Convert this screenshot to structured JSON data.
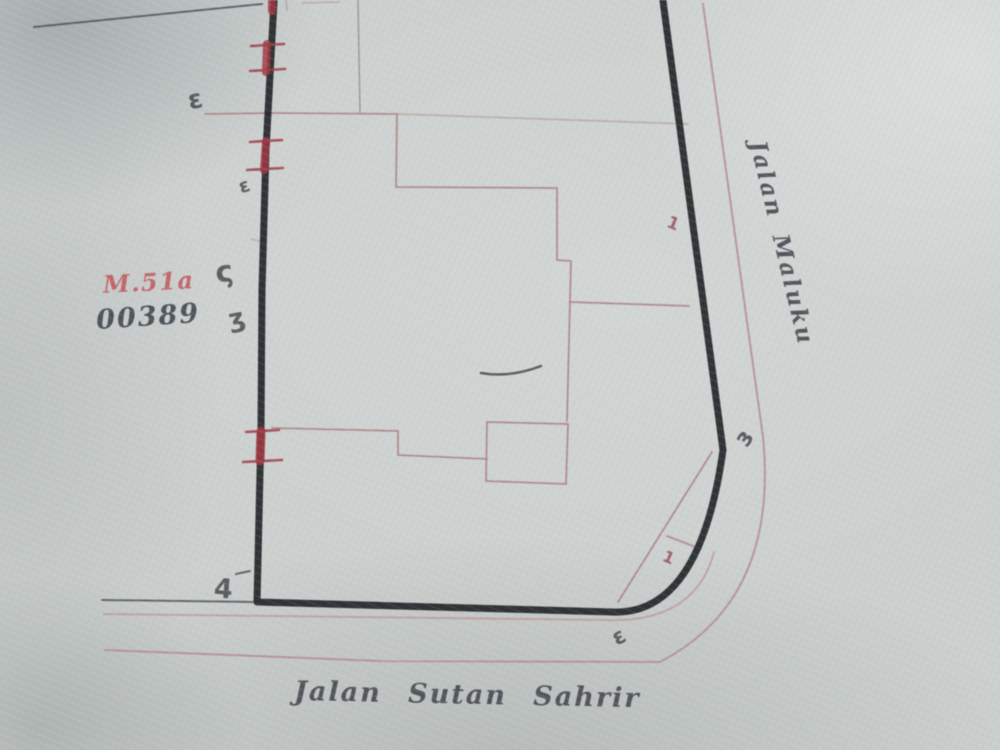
{
  "document": {
    "kind": "scanned cadastral sketch map",
    "sheet_code_red": "M.51a",
    "sheet_number": "00389"
  },
  "streets": {
    "right": "Jalan Maluku",
    "bottom": "Jalan Sutan Sahrir"
  },
  "handwritten_marks": [
    {
      "glyph": "ɛ",
      "location": "left boundary upper"
    },
    {
      "glyph": "ɛ",
      "location": "left boundary"
    },
    {
      "glyph": "ς",
      "location": "left boundary middle"
    },
    {
      "glyph": "ʒ",
      "location": "left boundary middle-lower"
    },
    {
      "glyph": "4",
      "location": "left boundary bottom corner"
    },
    {
      "glyph": "ɜ",
      "location": "right boundary at curve"
    },
    {
      "glyph": "ε",
      "location": "bottom boundary at curve"
    },
    {
      "glyph": "1",
      "location": "inside plot right edge"
    },
    {
      "glyph": "1",
      "location": "corner chord"
    }
  ],
  "colors": {
    "paper": "#cbd0cf",
    "plot_boundary": "#232528",
    "parcel_red": "#ad8486",
    "monument_red": "#a23742",
    "ink_dark": "#42464c",
    "label_red": "#c04d53"
  }
}
